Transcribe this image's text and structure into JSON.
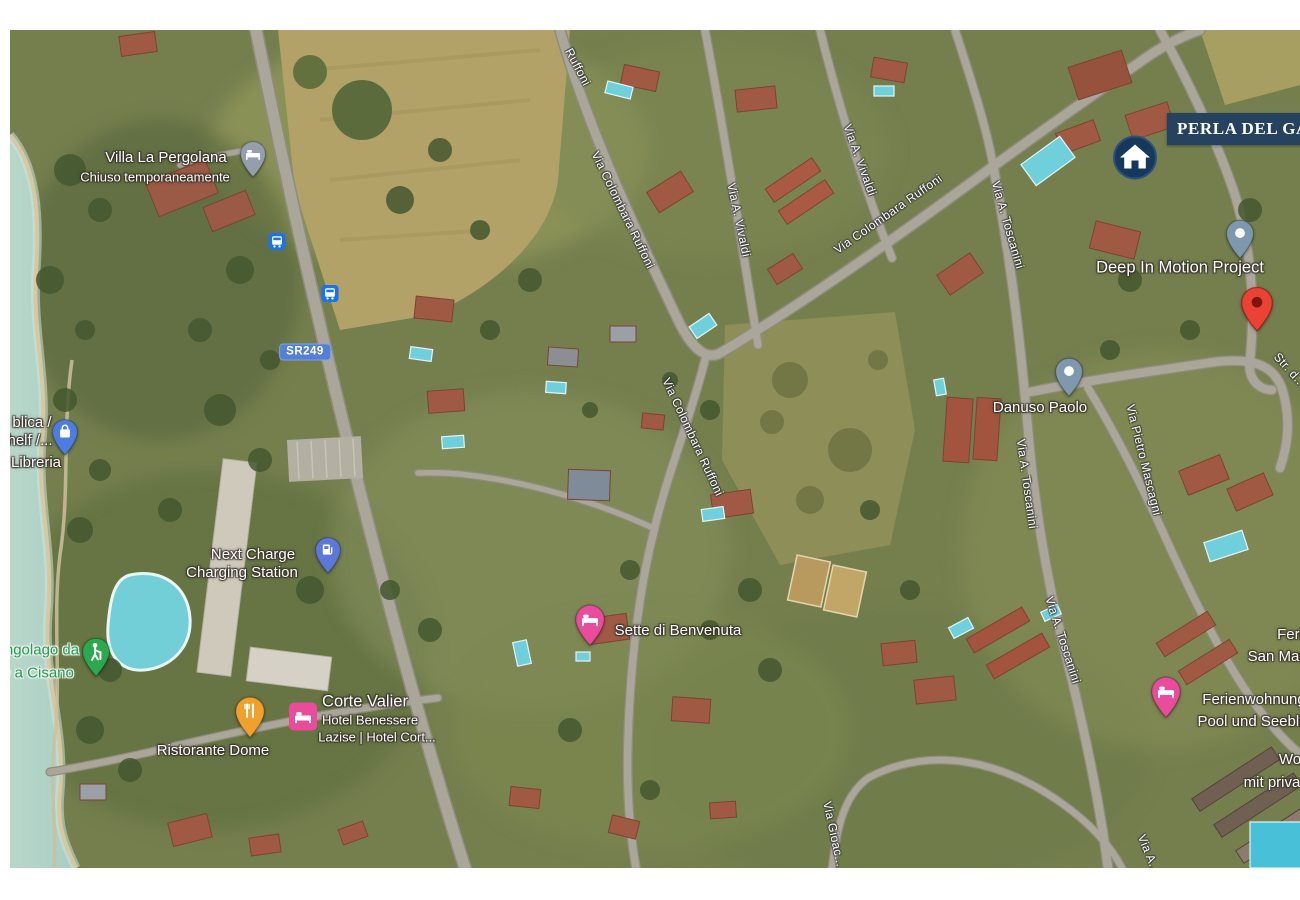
{
  "map": {
    "type": "satellite",
    "banner": {
      "text": "PERLA DEL GARDA"
    },
    "road_shield": {
      "text": "SR249"
    },
    "place_labels": {
      "villa_la_pergolana": {
        "name": "Villa La Pergolana",
        "status": "Chiuso temporaneamente"
      },
      "libreria": {
        "line1": "blica /",
        "line2": "helf /...",
        "line3": "Libreria"
      },
      "next_charge": {
        "line1": "Next Charge",
        "line2": "Charging Station"
      },
      "lungolago": {
        "line1": "ngolago da",
        "line2": "e a Cisano"
      },
      "ristorante_dome": {
        "name": "Ristorante Dome"
      },
      "corte_valier": {
        "name": "Corte Valier",
        "sub1": "Hotel Benessere",
        "sub2": "Lazise | Hotel Cort..."
      },
      "sette_di_benvenuta": {
        "name": "Sette di Benvenuta"
      },
      "danuso_paolo": {
        "name": "Danuso Paolo"
      },
      "deep_in_motion": {
        "name": "Deep In Motion Project"
      },
      "ferienwohnung": {
        "line1": "Ferienwohnung",
        "line2": "Pool und Seebli"
      },
      "ferien_san": {
        "line1": "Feri",
        "line2": "San Mar"
      },
      "wohnung": {
        "line1": "Wo",
        "line2": "mit priva"
      }
    },
    "road_labels": {
      "ruffoni_top": "Ruffoni",
      "colombara_1": "Via Colombara Ruffoni",
      "colombara_2": "Via Colombara Ruffoni",
      "colombara_3": "Via Colombara Ruffoni",
      "vivaldi_1": "Via A. Vivaldi",
      "vivaldi_2": "Via A. Vivaldi",
      "toscanini_1": "Via A. Toscanini",
      "toscanini_2": "Via A. Toscanini",
      "toscanini_3": "Via A. Toscanini",
      "mascagni": "Via Pietro Mascagni",
      "gioacchino": "Via Gioac...",
      "strada": "Str. d...",
      "via_a": "Via A..."
    },
    "colors": {
      "banner_bg": "#25435e",
      "red_pin": "#ea4335",
      "slate_pin": "#7e99ad",
      "grey_pin": "#93a0ac",
      "blue_pin": "#4d7de0",
      "charge_pin": "#5b77d9",
      "green_pin": "#2da84f",
      "orange_pin": "#f0a12c",
      "pink_pin": "#ea4c9c",
      "transit_blue": "#1a73e8",
      "shield_blue": "#547fd6",
      "green_text": "#18a15c"
    }
  }
}
